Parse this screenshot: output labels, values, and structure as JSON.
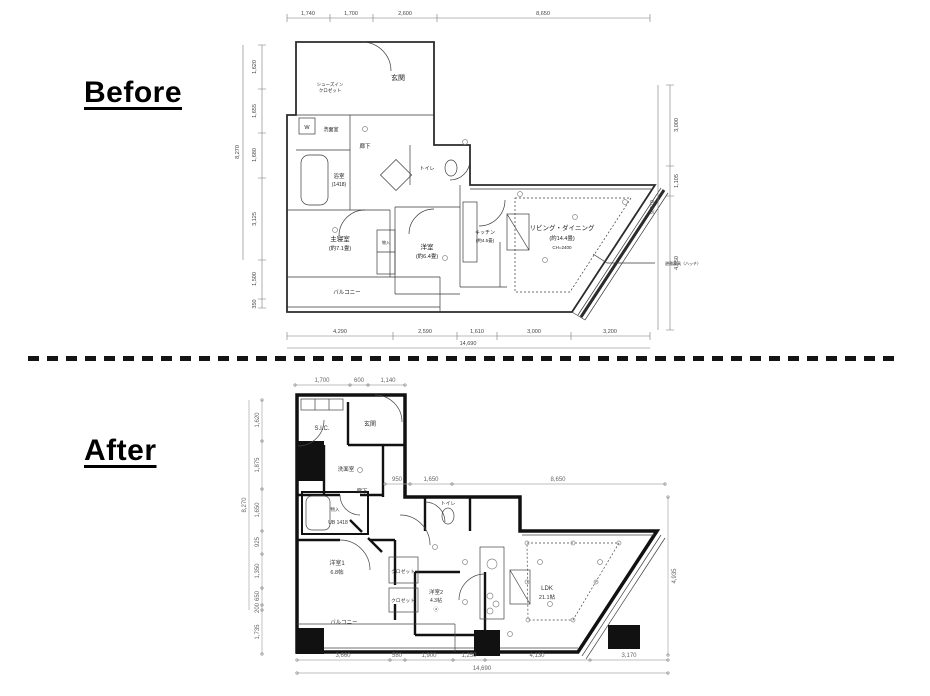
{
  "page": {
    "before_label": "Before",
    "after_label": "After"
  },
  "before_plan": {
    "rooms": {
      "entrance": "玄関",
      "shoe_closet_l1": "シューズイン",
      "shoe_closet_l2": "クロゼット",
      "washroom": "洗面室",
      "washer": "W",
      "bathroom": "浴室",
      "bathroom_size": "(1418)",
      "hallway": "廊下",
      "toilet": "トイレ",
      "master_bedroom": "主寝室",
      "master_bedroom_size": "(約7.1畳)",
      "bedroom": "洋室",
      "bedroom_size": "(約6.4畳)",
      "kitchen": "キッチン",
      "kitchen_size": "(約4.5畳)",
      "living_dining": "リビング・ダイニング",
      "living_dining_size": "(約14.4畳)",
      "living_dining_ch": "CH=2400",
      "storage": "物入",
      "balcony": "バルコニー",
      "evac_note": "避難器具（ハッチ）"
    },
    "dims": {
      "top": [
        "1,740",
        "1,700",
        "2,600",
        "8,650"
      ],
      "bottom": [
        "4,290",
        "2,590",
        "1,610",
        "3,000",
        "3,200"
      ],
      "bottom_total": "14,690",
      "left": [
        "1,620",
        "1,655",
        "1,680",
        "3,125",
        "1,500",
        "350"
      ],
      "left_total": "8,270",
      "right": [
        "3,000",
        "1,105",
        "4,950"
      ],
      "right_total": "9,070"
    }
  },
  "after_plan": {
    "rooms": {
      "sic": "S.I.C.",
      "entrance": "玄関",
      "washroom": "洗面室",
      "storage": "物入",
      "unit_bath": "UB 1418",
      "hallway": "廊下",
      "toilet": "トイレ",
      "bedroom1": "洋室1",
      "bedroom1_size": "6.8帖",
      "closet1": "クロゼット",
      "closet2": "クロゼット",
      "bedroom2": "洋室2",
      "bedroom2_size": "4.3帖",
      "bedroom2_mark": "ⓐ",
      "ldk": "LDK",
      "ldk_size": "21.1帖",
      "balcony": "バルコニー"
    },
    "dims": {
      "top": [
        "1,700",
        "600",
        "1,140"
      ],
      "mid": [
        "950",
        "1,650",
        "8,650"
      ],
      "bottom": [
        "3,660",
        "580",
        "1,900",
        "1,250",
        "4,130",
        "3,170"
      ],
      "bottom_total": "14,690",
      "left": [
        "1,620",
        "1,875",
        "1,650",
        "925",
        "1,350",
        "650",
        "200",
        "1,735"
      ],
      "left_total": "8,270",
      "right": "4,935"
    }
  }
}
